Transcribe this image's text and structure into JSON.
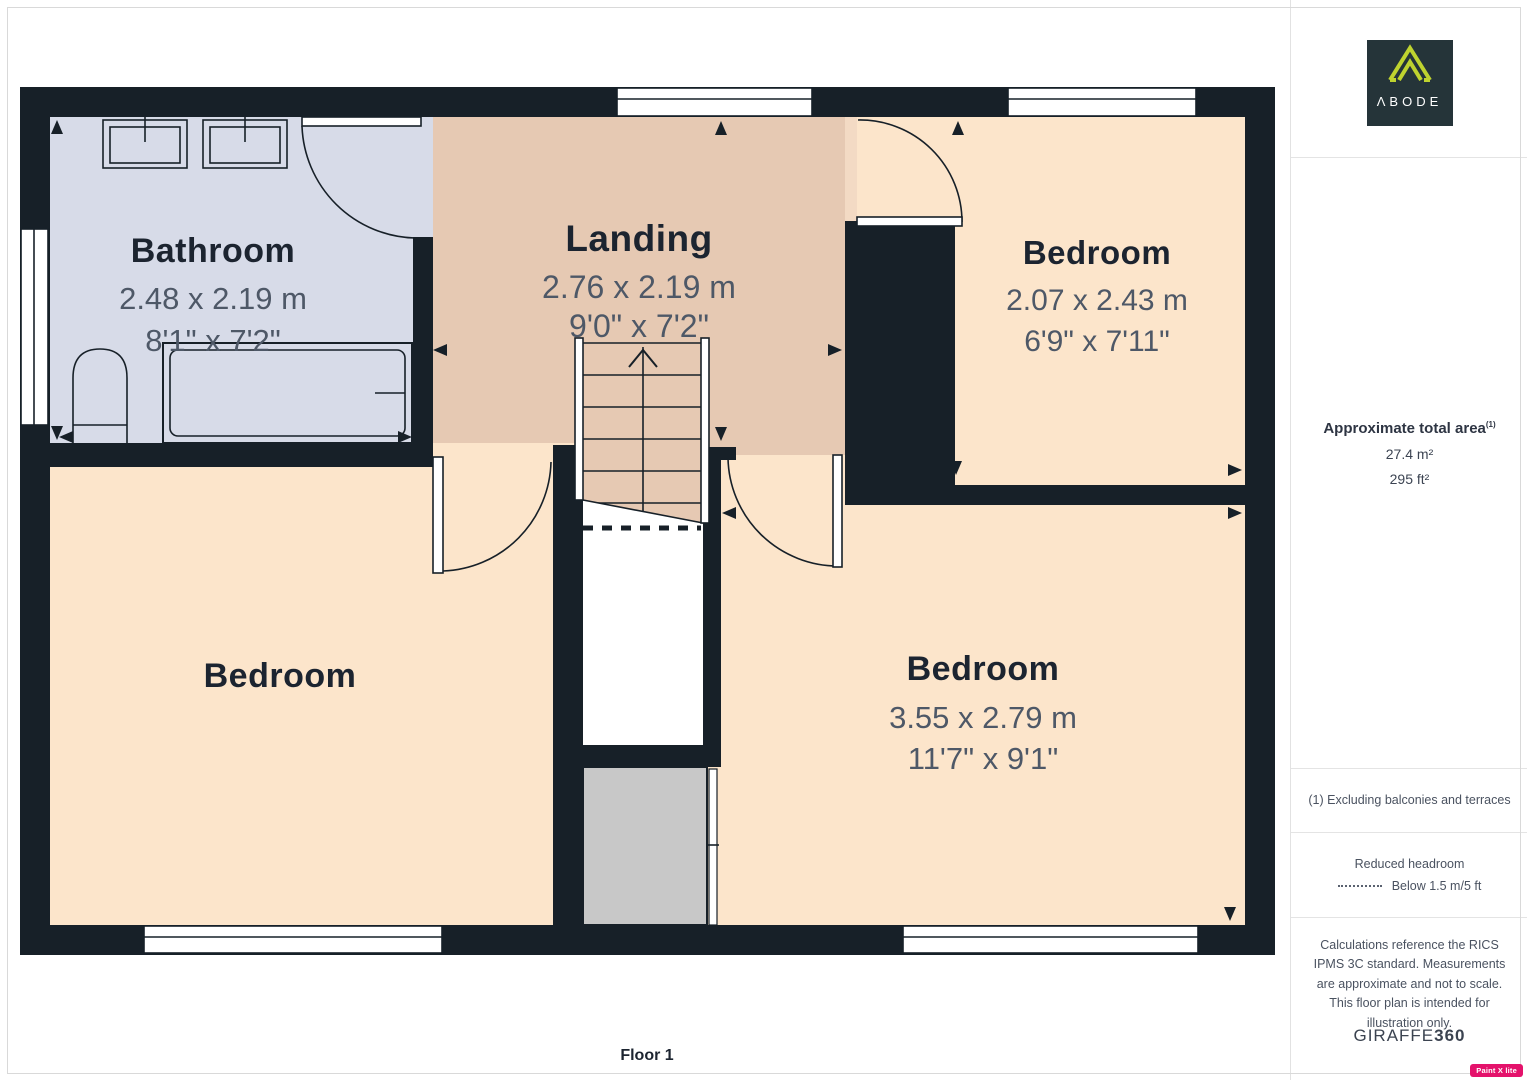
{
  "palette": {
    "wall": "#172028",
    "bathroom": "#d7dbe8",
    "landing": "#e6c9b3",
    "bedroom": "#fce5cb",
    "vestibule": "#f3dac4",
    "gray-block": "#c8c8c8",
    "room-title": "#1c2430",
    "room-dims": "#4e5867",
    "logo-bg": "#253439",
    "logo-mark": "#bfd32f",
    "badge-bg": "#e4126b"
  },
  "plan": {
    "floor_label": "Floor 1",
    "rooms": {
      "bathroom": {
        "name": "Bathroom",
        "dim_m": "2.48 x 2.19 m",
        "dim_ft": "8'1\" x 7'2\""
      },
      "landing": {
        "name": "Landing",
        "dim_m": "2.76 x 2.19 m",
        "dim_ft": "9'0\" x 7'2\""
      },
      "bedroom_top_right": {
        "name": "Bedroom",
        "dim_m": "2.07 x 2.43 m",
        "dim_ft": "6'9\" x 7'11\""
      },
      "bedroom_bottom_left": {
        "name": "Bedroom"
      },
      "bedroom_bottom_right": {
        "name": "Bedroom",
        "dim_m": "3.55 x 2.79 m",
        "dim_ft": "11'7\" x 9'1\""
      }
    }
  },
  "sidebar": {
    "logo": {
      "brand": "ΛBODE"
    },
    "area": {
      "title": "Approximate total area",
      "note_ref": "(1)",
      "metric": "27.4 m²",
      "imperial": "295 ft²"
    },
    "footnote": "(1) Excluding balconies and terraces",
    "legend": {
      "title": "Reduced headroom",
      "label": "Below 1.5 m/5 ft"
    },
    "disclaimer": "Calculations reference the RICS IPMS 3C standard. Measurements are approximate and not to scale. This floor plan is intended for illustration only.",
    "brand": {
      "name": "GIRAFFE",
      "suffix": "360"
    },
    "watermark": "Paint X lite"
  }
}
